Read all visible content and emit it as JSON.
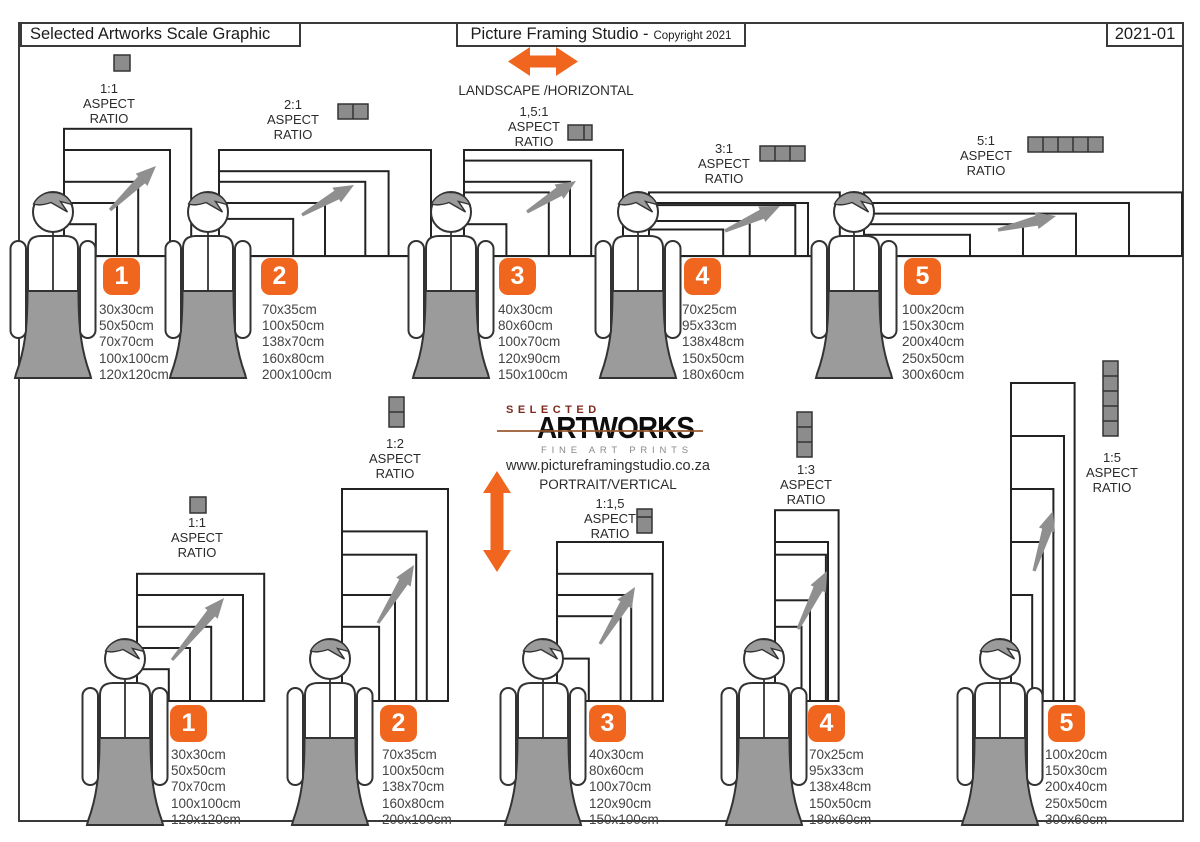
{
  "page": {
    "title_left": "Selected Artworks Scale Graphic",
    "title_center": "Picture Framing Studio -",
    "title_center_sub": "Copyright 2021",
    "title_right": "2021-01"
  },
  "center": {
    "landscape_label": "LANDSCAPE /HORIZONTAL",
    "portrait_label": "PORTRAIT/VERTICAL",
    "logo_top": "SELECTED",
    "logo_main": "ARTWORKS",
    "logo_sub": "FINE ART PRINTS",
    "website": "www.pictureframingstudio.co.za"
  },
  "aspect_words": [
    "ASPECT",
    "RATIO"
  ],
  "landscape_groups": [
    {
      "number": "1",
      "ratio": "1:1",
      "sizes": [
        "30x30cm",
        "50x50cm",
        "70x70cm",
        "100x100cm",
        "120x120cm"
      ]
    },
    {
      "number": "2",
      "ratio": "2:1",
      "sizes": [
        "70x35cm",
        "100x50cm",
        "138x70cm",
        "160x80cm",
        "200x100cm"
      ]
    },
    {
      "number": "3",
      "ratio": "1,5:1",
      "sizes": [
        "40x30cm",
        "80x60cm",
        "100x70cm",
        "120x90cm",
        "150x100cm"
      ]
    },
    {
      "number": "4",
      "ratio": "3:1",
      "sizes": [
        "70x25cm",
        "95x33cm",
        "138x48cm",
        "150x50cm",
        "180x60cm"
      ]
    },
    {
      "number": "5",
      "ratio": "5:1",
      "sizes": [
        "100x20cm",
        "150x30cm",
        "200x40cm",
        "250x50cm",
        "300x60cm"
      ]
    }
  ],
  "portrait_groups": [
    {
      "number": "1",
      "ratio": "1:1",
      "sizes": [
        "30x30cm",
        "50x50cm",
        "70x70cm",
        "100x100cm",
        "120x120cm"
      ]
    },
    {
      "number": "2",
      "ratio": "1:2",
      "sizes": [
        "70x35cm",
        "100x50cm",
        "138x70cm",
        "160x80cm",
        "200x100cm"
      ]
    },
    {
      "number": "3",
      "ratio": "1:1,5",
      "sizes": [
        "40x30cm",
        "80x60cm",
        "100x70cm",
        "120x90cm",
        "150x100cm"
      ]
    },
    {
      "number": "4",
      "ratio": "1:3",
      "sizes": [
        "70x25cm",
        "95x33cm",
        "138x48cm",
        "150x50cm",
        "180x60cm"
      ]
    },
    {
      "number": "5",
      "ratio": "1:5",
      "sizes": [
        "100x20cm",
        "150x30cm",
        "200x40cm",
        "250x50cm",
        "300x60cm"
      ]
    }
  ],
  "colors": {
    "accent_orange": "#f0661f",
    "figure_gray": "#9b9b9b",
    "arrow_gray": "#8f8f8f",
    "icon_gray": "#8c8c8c",
    "outline": "#333333",
    "frame_stroke": "#222222",
    "logo_red": "#7d2a1c"
  }
}
